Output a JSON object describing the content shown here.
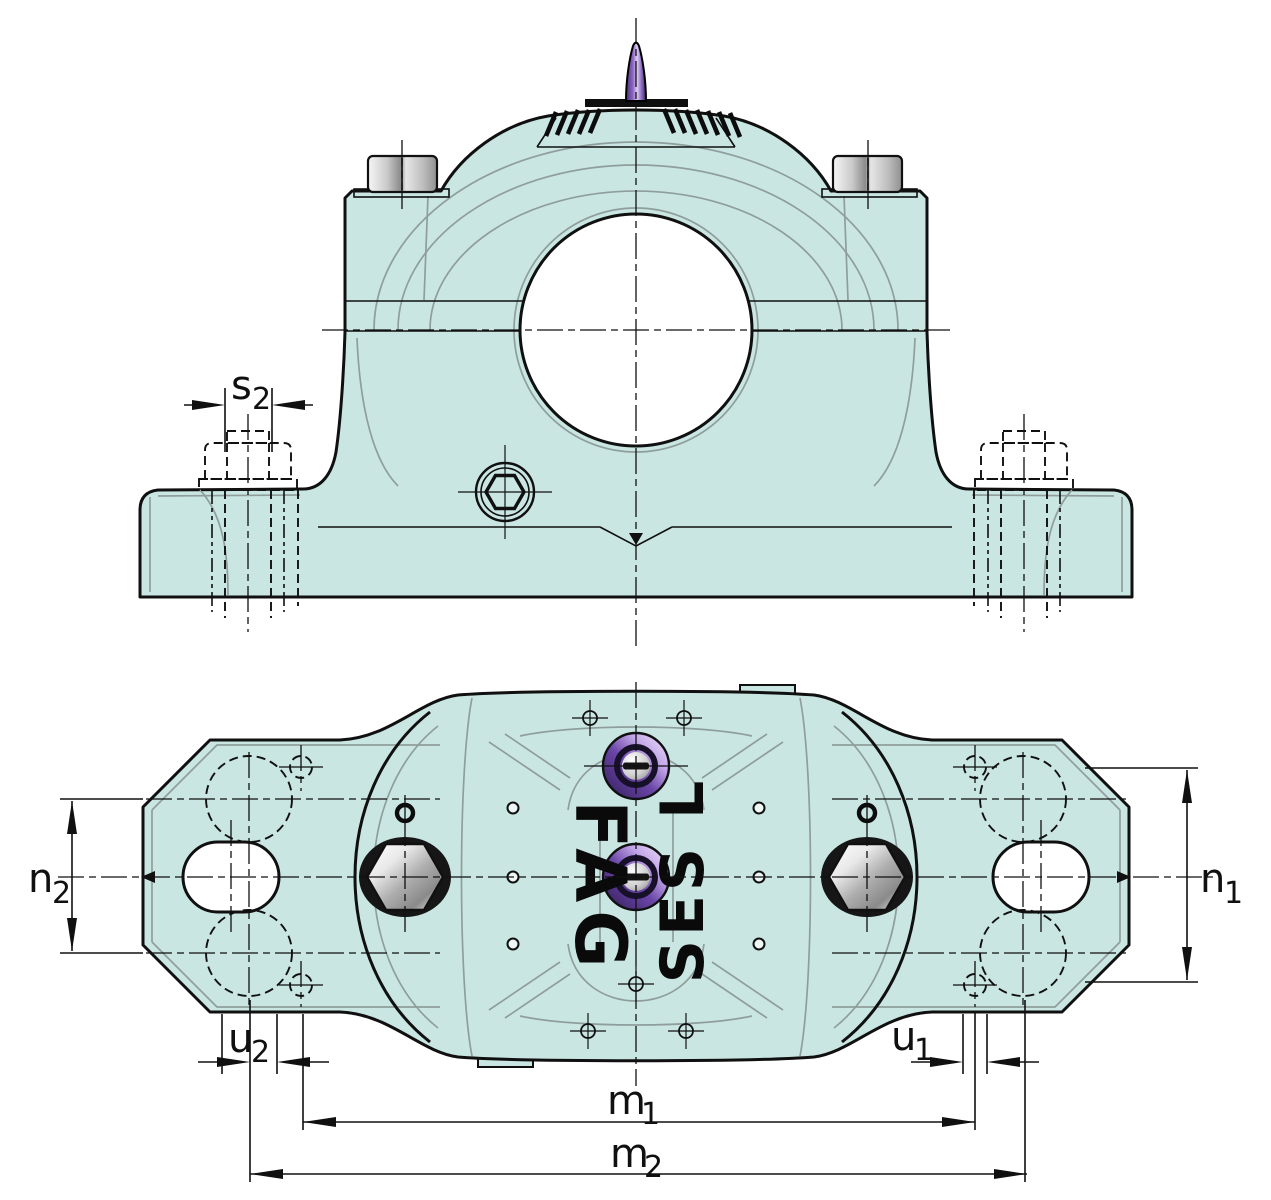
{
  "document": {
    "description": "Split plummer block housing engineering drawing, front elevation (top) and plan view (bottom)",
    "background": "#ffffff"
  },
  "branding": {
    "logo_text": "FAG",
    "series_text": "SES L"
  },
  "labels": {
    "s2": {
      "base": "s",
      "sub": "2"
    },
    "n2": {
      "base": "n",
      "sub": "2"
    },
    "n1": {
      "base": "n",
      "sub": "1"
    },
    "u2": {
      "base": "u",
      "sub": "2"
    },
    "u1": {
      "base": "u",
      "sub": "1"
    },
    "m1": {
      "base": "m",
      "sub": "1"
    },
    "m2": {
      "base": "m",
      "sub": "2"
    }
  },
  "colors": {
    "background": "#ffffff",
    "housing_fill": "#c9e6e2",
    "outline": "#101010",
    "detail_line": "#8f9e9c",
    "dimension_line": "#101010",
    "text": "#101010",
    "grease_purple": "#6b46a8",
    "grease_purple_dark": "#2c1b4e",
    "grease_purple_light": "#f0e9fc",
    "metal_light": "#fafafa",
    "metal_dark": "#7c7c7c",
    "hole_fill": "#ffffff"
  }
}
